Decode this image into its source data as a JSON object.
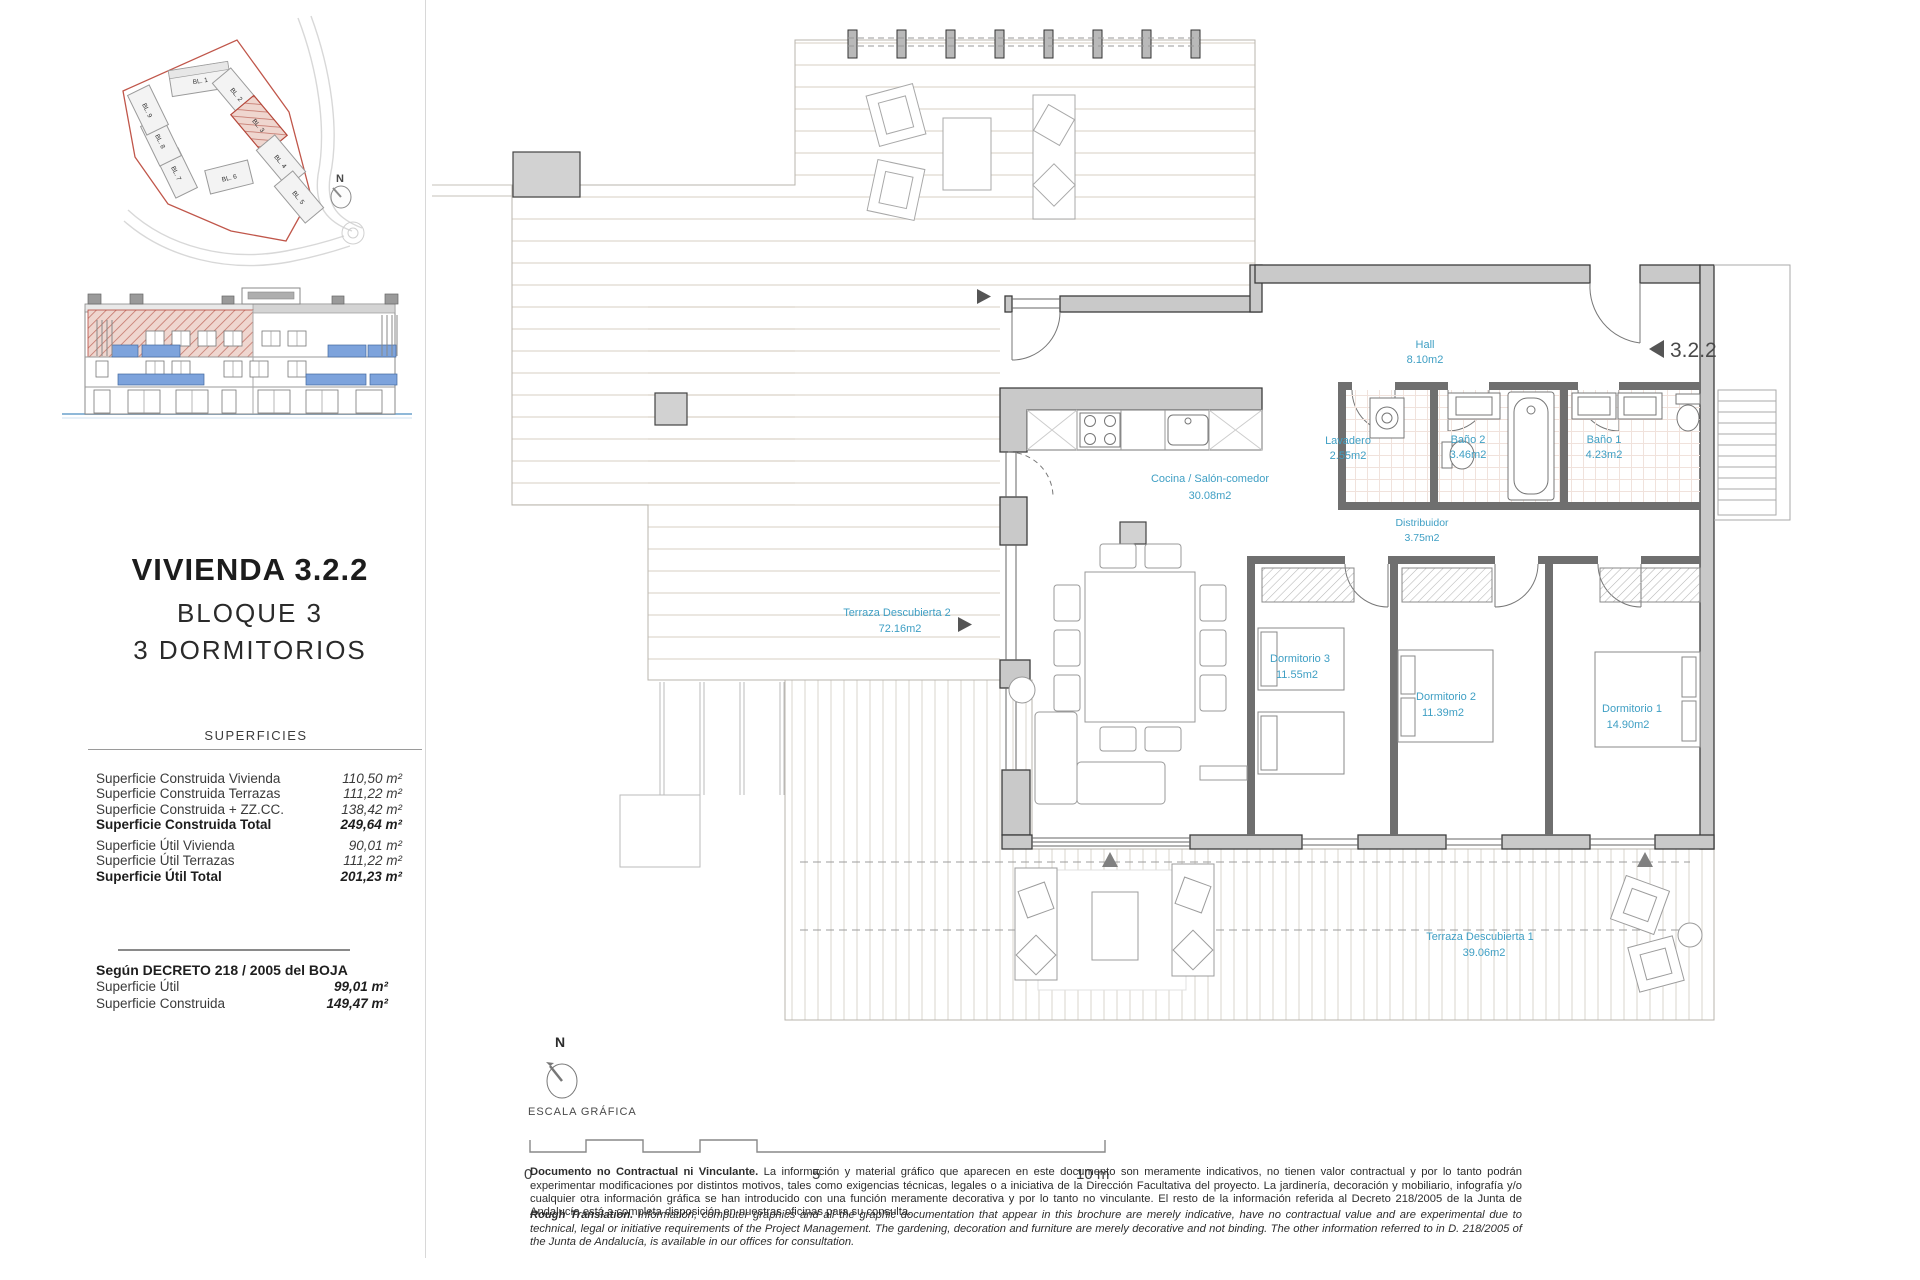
{
  "left_panel": {
    "title": "VIVIENDA 3.2.2",
    "subtitle_block": "BLOQUE 3",
    "subtitle_rooms": "3 DORMITORIOS",
    "superficies_heading": "SUPERFICIES",
    "table": {
      "rows": [
        {
          "label": "Superficie Construida Vivienda",
          "value": "110,50 m²"
        },
        {
          "label": "Superficie Construida Terrazas",
          "value": "111,22 m²"
        },
        {
          "label": "Superficie Construida + ZZ.CC.",
          "value": "138,42 m²"
        },
        {
          "label": "Superficie Construida Total",
          "value": "249,64 m²"
        },
        {
          "label": "Superficie Útil Vivienda",
          "value": "90,01 m²"
        },
        {
          "label": "Superficie Útil Terrazas",
          "value": "111,22 m²"
        },
        {
          "label": "Superficie Útil Total",
          "value": "201,23 m²"
        }
      ]
    },
    "decreto": {
      "heading": "Según DECRETO 218 / 2005 del BOJA",
      "rows": [
        {
          "label": "Superficie Útil",
          "value": "99,01 m²"
        },
        {
          "label": "Superficie Construida",
          "value": "149,47 m²"
        }
      ]
    },
    "site_plan": {
      "north_label": "N",
      "highlighted": "BL. 3",
      "blocks": [
        "BL. 1",
        "BL. 2",
        "BL. 3",
        "BL. 4",
        "BL. 5",
        "BL. 6",
        "BL. 7",
        "BL. 8",
        "BL. 9"
      ]
    }
  },
  "plan": {
    "unit_marker": "3.2.2",
    "rooms": [
      {
        "name": "Hall",
        "area": "8.10m2"
      },
      {
        "name": "Lavadero",
        "area": "2.55m2"
      },
      {
        "name": "Baño 2",
        "area": "3.46m2"
      },
      {
        "name": "Baño 1",
        "area": "4.23m2"
      },
      {
        "name": "Distribuidor",
        "area": "3.75m2"
      },
      {
        "name": "Cocina / Salón-comedor",
        "area": "30.08m2"
      },
      {
        "name": "Dormitorio 3",
        "area": "11.55m2"
      },
      {
        "name": "Dormitorio 2",
        "area": "11.39m2"
      },
      {
        "name": "Dormitorio 1",
        "area": "14.90m2"
      },
      {
        "name": "Terraza Descubierta 2",
        "area": "72.16m2"
      },
      {
        "name": "Terraza Descubierta 1",
        "area": "39.06m2"
      }
    ]
  },
  "scale_bar": {
    "north_label": "N",
    "label": "ESCALA GRÁFICA",
    "tick0": "0",
    "tick5": "5",
    "tick10": "10 m"
  },
  "disclaimer": {
    "es_lead": "Documento no Contractual ni Vinculante.",
    "es_body": "La información y material gráfico que aparecen en este documento son meramente indicativos, no tienen valor contractual y por lo tanto podrán experimentar modificaciones por distintos motivos, tales como exigencias técnicas, legales o a iniciativa de la Dirección Facultativa del proyecto. La jardinería, decoración y mobiliario, infografía y/o cualquier otra información gráfica se han introducido con una función meramente decorativa y por lo tanto no vinculante. El resto de la información referida al Decreto 218/2005 de la Junta de Andalucía está a completa disposición en nuestras oficinas para su consulta.",
    "en_lead": "Rough Translation.",
    "en_body": "Information, computer graphics and all the graphic documentation that appear in this brochure are merely indicative, have no contractual value and are experimental due to technical, legal or initiative requirements of the Project Management. The gardening, decoration and furniture are merely decorative and not binding. The other information referred to in D. 218/2005 of the Junta de Andalucía, is available in our offices for consultation."
  },
  "colors": {
    "label_blue": "#3f9fc4",
    "highlight_red": "#b5473a",
    "balcony_blue": "#7da3dc",
    "wall_gray": "#c9c9c9",
    "partition_gray": "#6f6f6f"
  }
}
